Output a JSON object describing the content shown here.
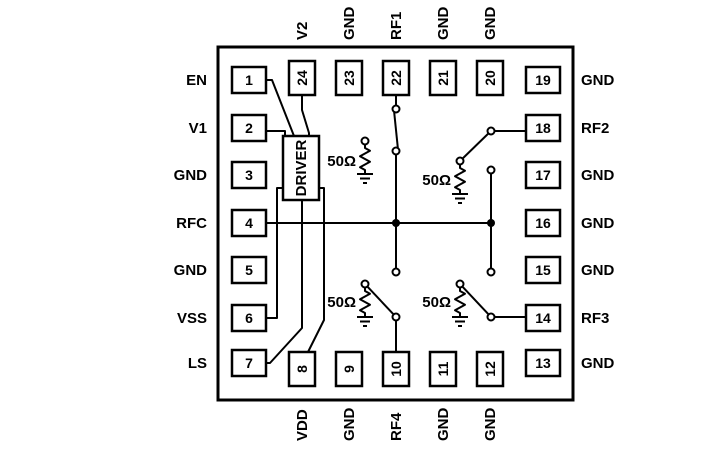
{
  "colors": {
    "ink": "#000000",
    "paper": "#ffffff"
  },
  "driver": {
    "label": "DRIVER"
  },
  "terminations": [
    {
      "label": "50Ω"
    },
    {
      "label": "50Ω"
    },
    {
      "label": "50Ω"
    },
    {
      "label": "50Ω"
    }
  ],
  "pins": {
    "left": [
      {
        "number": "1",
        "label": "EN"
      },
      {
        "number": "2",
        "label": "V1"
      },
      {
        "number": "3",
        "label": "GND"
      },
      {
        "number": "4",
        "label": "RFC"
      },
      {
        "number": "5",
        "label": "GND"
      },
      {
        "number": "6",
        "label": "VSS"
      },
      {
        "number": "7",
        "label": "LS"
      }
    ],
    "top": [
      {
        "number": "24",
        "label": "V2"
      },
      {
        "number": "23",
        "label": "GND"
      },
      {
        "number": "22",
        "label": "RF1"
      },
      {
        "number": "21",
        "label": "GND"
      },
      {
        "number": "20",
        "label": "GND"
      }
    ],
    "right": [
      {
        "number": "19",
        "label": "GND"
      },
      {
        "number": "18",
        "label": "RF2"
      },
      {
        "number": "17",
        "label": "GND"
      },
      {
        "number": "16",
        "label": "GND"
      },
      {
        "number": "15",
        "label": "GND"
      },
      {
        "number": "14",
        "label": "RF3"
      },
      {
        "number": "13",
        "label": "GND"
      }
    ],
    "bottom": [
      {
        "number": "8",
        "label": "VDD"
      },
      {
        "number": "9",
        "label": "GND"
      },
      {
        "number": "10",
        "label": "RF4"
      },
      {
        "number": "11",
        "label": "GND"
      },
      {
        "number": "12",
        "label": "GND"
      }
    ]
  }
}
